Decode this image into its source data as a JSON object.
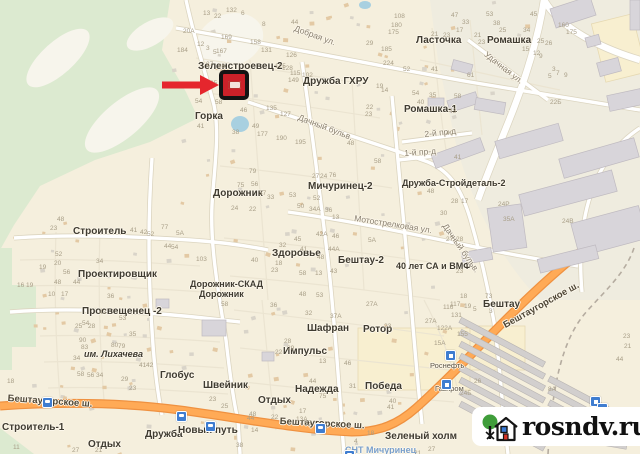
{
  "map": {
    "colors": {
      "land": "#f5efdd",
      "forest": "#dcead0",
      "clearing": "#f7f5ec",
      "industrial": "#efecdf",
      "commercial": "#f8efd0",
      "road_fill": "#ffffff",
      "road_casing": "#dcd5c0",
      "highway_fill": "#ffaa56",
      "highway_casing": "#ef9140",
      "building": "#d8d5da",
      "water": "#a8d0e0",
      "marker_red": "#cb2129",
      "arrow_red": "#e5262d"
    },
    "area_labels": [
      [
        "Зеленстроевец-2",
        198,
        62
      ],
      [
        "Дружба ГХРУ",
        303,
        77
      ],
      [
        "Горка",
        195,
        112
      ],
      [
        "Ласточка",
        416,
        36
      ],
      [
        "Ромашка",
        487,
        36
      ],
      [
        "Ромашка-1",
        404,
        105
      ],
      [
        "Дружба-Стройдеталь-2",
        402,
        179,
        9
      ],
      [
        "Мичуринец-2",
        308,
        182
      ],
      [
        "Дорожник",
        213,
        189
      ],
      [
        "Строитель",
        73,
        227
      ],
      [
        "Проектировщик",
        78,
        270
      ],
      [
        "Здоровье",
        272,
        249
      ],
      [
        "Бештау-2",
        338,
        256
      ],
      [
        "40 лет СА и ВМФ",
        396,
        262,
        9
      ],
      [
        "Дорожник-СКАД",
        190,
        280,
        9
      ],
      [
        "Дорожник",
        199,
        290,
        9
      ],
      [
        "Просвещенец -2",
        82,
        307
      ],
      [
        "им. Лихачева",
        84,
        350,
        9,
        "i"
      ],
      [
        "Глобус",
        160,
        371
      ],
      [
        "Швейник",
        203,
        381
      ],
      [
        "Шафран",
        307,
        324
      ],
      [
        "Ротор",
        363,
        325
      ],
      [
        "Импульс",
        283,
        347
      ],
      [
        "Надежда",
        295,
        385
      ],
      [
        "Победа",
        365,
        382
      ],
      [
        "Отдых",
        258,
        396
      ],
      [
        "Отдых",
        88,
        440
      ],
      [
        "Дружба",
        145,
        430
      ],
      [
        "Новый путь",
        178,
        426
      ],
      [
        "Строитель-1",
        2,
        423
      ],
      [
        "Бештау",
        483,
        300
      ],
      [
        "Зеленый холм",
        385,
        432
      ],
      [
        "СНТ Мичуринец",
        345,
        446,
        9,
        "blue"
      ]
    ],
    "street_labels": [
      [
        "Добрая ул.",
        296,
        24,
        20
      ],
      [
        "Удачная ул.",
        488,
        50,
        38
      ],
      [
        "Дачный бульв.",
        300,
        113,
        21
      ],
      [
        "Дачный бульв.",
        448,
        222,
        55
      ],
      [
        "Мотострелковая ул.",
        355,
        214,
        9
      ],
      [
        "2-й пр-д",
        424,
        130,
        -6
      ],
      [
        "1-й пр-д",
        404,
        149,
        -4
      ]
    ],
    "road_labels": [
      [
        "Бештаугорское ш.",
        8,
        394,
        4
      ],
      [
        "Бештаугорское ш.",
        280,
        417,
        3
      ],
      [
        "Бештаугорское ш.",
        502,
        322,
        -29
      ]
    ],
    "poi_labels": [
      [
        "Роснефть",
        430,
        362
      ],
      [
        "Газпром",
        435,
        385
      ]
    ],
    "house_numbers": [
      [
        "20А",
        183,
        29
      ],
      [
        "184",
        177,
        48
      ],
      [
        "12",
        197,
        42
      ],
      [
        "3",
        206,
        46
      ],
      [
        "5",
        213,
        50
      ],
      [
        "27",
        206,
        62
      ],
      [
        "28",
        218,
        64
      ],
      [
        "35",
        210,
        81
      ],
      [
        "54",
        195,
        99
      ],
      [
        "58",
        215,
        100
      ],
      [
        "41",
        197,
        124
      ],
      [
        "46",
        240,
        108
      ],
      [
        "49",
        252,
        124
      ],
      [
        "38",
        232,
        130
      ],
      [
        "13",
        203,
        11
      ],
      [
        "22",
        214,
        14
      ],
      [
        "132",
        226,
        8
      ],
      [
        "6",
        241,
        11
      ],
      [
        "44",
        291,
        20
      ],
      [
        "8",
        262,
        22
      ],
      [
        "169",
        221,
        35
      ],
      [
        "167",
        216,
        49
      ],
      [
        "158",
        250,
        40
      ],
      [
        "131",
        261,
        48
      ],
      [
        "126",
        286,
        53
      ],
      [
        "128",
        282,
        66
      ],
      [
        "149",
        288,
        78
      ],
      [
        "115",
        290,
        71
      ],
      [
        "102",
        302,
        73
      ],
      [
        "125",
        275,
        64
      ],
      [
        "135",
        266,
        106
      ],
      [
        "127",
        280,
        112
      ],
      [
        "177",
        257,
        132
      ],
      [
        "195",
        295,
        140
      ],
      [
        "190",
        276,
        136
      ],
      [
        "47",
        451,
        13
      ],
      [
        "33",
        462,
        20
      ],
      [
        "17",
        456,
        28
      ],
      [
        "21",
        431,
        32
      ],
      [
        "23",
        443,
        33
      ],
      [
        "108",
        394,
        14
      ],
      [
        "180",
        391,
        23
      ],
      [
        "175",
        388,
        30
      ],
      [
        "29",
        366,
        41
      ],
      [
        "185",
        381,
        47
      ],
      [
        "224",
        383,
        61
      ],
      [
        "52",
        403,
        67
      ],
      [
        "41",
        431,
        67
      ],
      [
        "19",
        376,
        84
      ],
      [
        "14",
        381,
        88
      ],
      [
        "54",
        412,
        91
      ],
      [
        "40",
        417,
        100
      ],
      [
        "35",
        429,
        93
      ],
      [
        "22",
        366,
        105
      ],
      [
        "23",
        365,
        112
      ],
      [
        "58",
        454,
        94
      ],
      [
        "43",
        449,
        109
      ],
      [
        "53",
        486,
        12
      ],
      [
        "38",
        493,
        21
      ],
      [
        "25",
        499,
        28
      ],
      [
        "21",
        474,
        33
      ],
      [
        "23",
        478,
        40
      ],
      [
        "15",
        522,
        47
      ],
      [
        "12",
        533,
        51
      ],
      [
        "9",
        539,
        54
      ],
      [
        "61",
        467,
        73
      ],
      [
        "3",
        552,
        67
      ],
      [
        "5",
        548,
        74
      ],
      [
        "7",
        556,
        71
      ],
      [
        "9",
        564,
        73
      ],
      [
        "22Б",
        550,
        100
      ],
      [
        "45",
        530,
        12
      ],
      [
        "34",
        523,
        28
      ],
      [
        "26",
        545,
        41
      ],
      [
        "25",
        537,
        39
      ],
      [
        "160",
        558,
        23
      ],
      [
        "175",
        566,
        30
      ],
      [
        "79",
        249,
        169
      ],
      [
        "75",
        237,
        183
      ],
      [
        "56",
        251,
        182
      ],
      [
        "37",
        259,
        191
      ],
      [
        "33",
        267,
        195
      ],
      [
        "24",
        231,
        206
      ],
      [
        "22",
        249,
        207
      ],
      [
        "53",
        289,
        193
      ],
      [
        "52",
        313,
        196
      ],
      [
        "50",
        297,
        204
      ],
      [
        "34А",
        309,
        207
      ],
      [
        "36",
        325,
        208
      ],
      [
        "13",
        332,
        215
      ],
      [
        "27",
        312,
        174
      ],
      [
        "24",
        320,
        174
      ],
      [
        "76",
        329,
        173
      ],
      [
        "48",
        347,
        141
      ],
      [
        "46",
        332,
        234
      ],
      [
        "42А",
        316,
        232
      ],
      [
        "41",
        300,
        247
      ],
      [
        "44А",
        328,
        247
      ],
      [
        "32",
        279,
        243
      ],
      [
        "45",
        294,
        237
      ],
      [
        "40",
        251,
        258
      ],
      [
        "18",
        275,
        261
      ],
      [
        "23",
        271,
        268
      ],
      [
        "58",
        299,
        271
      ],
      [
        "13",
        315,
        271
      ],
      [
        "43",
        330,
        269
      ],
      [
        "48",
        317,
        255
      ],
      [
        "58",
        374,
        159
      ],
      [
        "5А",
        368,
        238
      ],
      [
        "23",
        50,
        226
      ],
      [
        "48",
        57,
        217
      ],
      [
        "41",
        130,
        228
      ],
      [
        "42",
        140,
        230
      ],
      [
        "52",
        147,
        232
      ],
      [
        "77",
        161,
        225
      ],
      [
        "5А",
        176,
        231
      ],
      [
        "44",
        164,
        244
      ],
      [
        "54",
        171,
        245
      ],
      [
        "52",
        55,
        252
      ],
      [
        "20",
        54,
        261
      ],
      [
        "19",
        39,
        265
      ],
      [
        "56",
        63,
        270
      ],
      [
        "34",
        96,
        259
      ],
      [
        "48",
        54,
        280
      ],
      [
        "44",
        73,
        280
      ],
      [
        "16",
        17,
        283
      ],
      [
        "19",
        26,
        283
      ],
      [
        "10",
        48,
        292
      ],
      [
        "17",
        61,
        292
      ],
      [
        "36",
        107,
        294
      ],
      [
        "103",
        196,
        257
      ],
      [
        "90",
        79,
        338
      ],
      [
        "83",
        81,
        345
      ],
      [
        "80",
        111,
        343
      ],
      [
        "79",
        118,
        344
      ],
      [
        "34",
        73,
        356
      ],
      [
        "58",
        77,
        372
      ],
      [
        "56",
        87,
        373
      ],
      [
        "34",
        96,
        373
      ],
      [
        "29",
        121,
        377
      ],
      [
        "41",
        139,
        363
      ],
      [
        "42",
        146,
        363
      ],
      [
        "54",
        82,
        321
      ],
      [
        "43",
        99,
        310
      ],
      [
        "35",
        129,
        332
      ],
      [
        "25",
        75,
        324
      ],
      [
        "28",
        88,
        324
      ],
      [
        "23",
        129,
        386
      ],
      [
        "18",
        7,
        379
      ],
      [
        "53",
        119,
        316
      ],
      [
        "11",
        13,
        445
      ],
      [
        "27",
        72,
        448
      ],
      [
        "21",
        95,
        448
      ],
      [
        "36",
        270,
        303
      ],
      [
        "37А",
        330,
        314
      ],
      [
        "27А",
        366,
        302
      ],
      [
        "48",
        299,
        292
      ],
      [
        "53",
        316,
        293
      ],
      [
        "58",
        221,
        302
      ],
      [
        "22",
        275,
        350
      ],
      [
        "28",
        284,
        339
      ],
      [
        "13",
        319,
        359
      ],
      [
        "23",
        384,
        324
      ],
      [
        "46",
        344,
        361
      ],
      [
        "44",
        309,
        379
      ],
      [
        "31",
        349,
        384
      ],
      [
        "75",
        319,
        394
      ],
      [
        "40",
        389,
        399
      ],
      [
        "41",
        387,
        405
      ],
      [
        "23",
        209,
        397
      ],
      [
        "25",
        221,
        404
      ],
      [
        "48",
        249,
        412
      ],
      [
        "44",
        247,
        416
      ],
      [
        "17",
        299,
        409
      ],
      [
        "53",
        304,
        421
      ],
      [
        "14",
        251,
        428
      ],
      [
        "22",
        271,
        415
      ],
      [
        "38",
        236,
        443
      ],
      [
        "4",
        354,
        439
      ],
      [
        "18",
        367,
        431
      ],
      [
        "27",
        428,
        447
      ],
      [
        "21",
        414,
        451
      ],
      [
        "32",
        305,
        311
      ],
      [
        "29",
        287,
        346
      ],
      [
        "13А",
        296,
        417
      ],
      [
        "116",
        443,
        305
      ],
      [
        "117",
        450,
        302
      ],
      [
        "131",
        451,
        313
      ],
      [
        "122А",
        437,
        326
      ],
      [
        "155",
        457,
        332
      ],
      [
        "15А",
        434,
        341
      ],
      [
        "19",
        464,
        304
      ],
      [
        "5",
        473,
        307
      ],
      [
        "3",
        489,
        309
      ],
      [
        "18",
        460,
        294
      ],
      [
        "73",
        485,
        294
      ],
      [
        "23",
        623,
        334
      ],
      [
        "21",
        624,
        344
      ],
      [
        "44",
        616,
        357
      ],
      [
        "8А",
        548,
        387
      ],
      [
        "24Р",
        498,
        202
      ],
      [
        "35А",
        503,
        217
      ],
      [
        "24В",
        562,
        219
      ],
      [
        "48",
        427,
        189
      ],
      [
        "30",
        440,
        211
      ],
      [
        "28",
        451,
        199
      ],
      [
        "17",
        461,
        199
      ],
      [
        "27",
        446,
        237
      ],
      [
        "28",
        456,
        237
      ],
      [
        "23",
        456,
        269
      ],
      [
        "26",
        474,
        379
      ],
      [
        "24Б",
        460,
        391
      ],
      [
        "40",
        446,
        131
      ],
      [
        "41",
        454,
        155
      ],
      [
        "27А",
        425,
        319
      ]
    ],
    "bus_stops": [
      [
        42,
        397
      ],
      [
        176,
        411
      ],
      [
        205,
        421
      ],
      [
        315,
        423
      ],
      [
        344,
        450
      ]
    ],
    "poi_icons": [
      [
        445,
        350
      ],
      [
        441,
        379
      ],
      [
        590,
        396
      ],
      [
        597,
        403
      ]
    ],
    "marker": {
      "x": 219,
      "y": 70,
      "size": 30
    },
    "arrow": {
      "x1": 162,
      "x2": 219,
      "y": 85
    }
  },
  "watermark": {
    "text": "rosndv.ru"
  }
}
